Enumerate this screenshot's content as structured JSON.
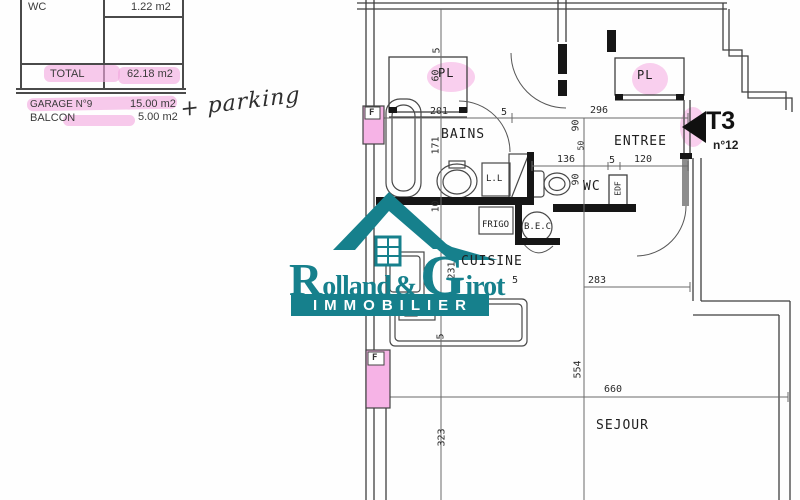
{
  "document": {
    "type": "apartment floor plan scan"
  },
  "surface_table": {
    "rows": [
      {
        "label": "WC",
        "value": "1.22 m2"
      },
      {
        "label": "TOTAL",
        "value": "62.18 m2"
      }
    ],
    "annex_rows": [
      {
        "label": "GARAGE N°9",
        "value": "15.00 m2"
      },
      {
        "label": "BALCON",
        "value": "5.00 m2"
      }
    ],
    "handwritten_note": "+ parking"
  },
  "logo": {
    "r": "R",
    "olland": "olland",
    "amp": "&",
    "g": "G",
    "irot": "irot",
    "banner": "IMMOBILIER"
  },
  "unit": {
    "type": "T3",
    "number": "n°12"
  },
  "rooms": {
    "pl_left": "PL",
    "pl_right": "PL",
    "bains": "BAINS",
    "entree": "ENTREE",
    "wc": "WC",
    "cuisine": "CUISINE",
    "sejour": "SEJOUR"
  },
  "fixtures": {
    "lave_linge": "L.L",
    "frigo": "FRIGO",
    "bec": "B.E.C",
    "edf": "EDF"
  },
  "windows": {
    "f1": "F",
    "f2": "F"
  },
  "dims": {
    "pl_wall": "5",
    "pl_depth": "60",
    "bains_width": "201",
    "bains_wall": "5",
    "entree_width": "296",
    "bains_height": "171",
    "entree_height": "90",
    "door_width": "50",
    "wc_width": "136",
    "wc_wall": "5",
    "entry_width": "120",
    "wc_height": "90",
    "wall_10": "10",
    "cuisine_height": "231",
    "cuisine_wall": "5",
    "hall_width": "283",
    "counter_wall": "5",
    "sejour_left": "323",
    "sejour_height": "554",
    "sejour_width": "660"
  },
  "colors": {
    "teal": "#16808C",
    "pink": "#F2A8DF"
  }
}
